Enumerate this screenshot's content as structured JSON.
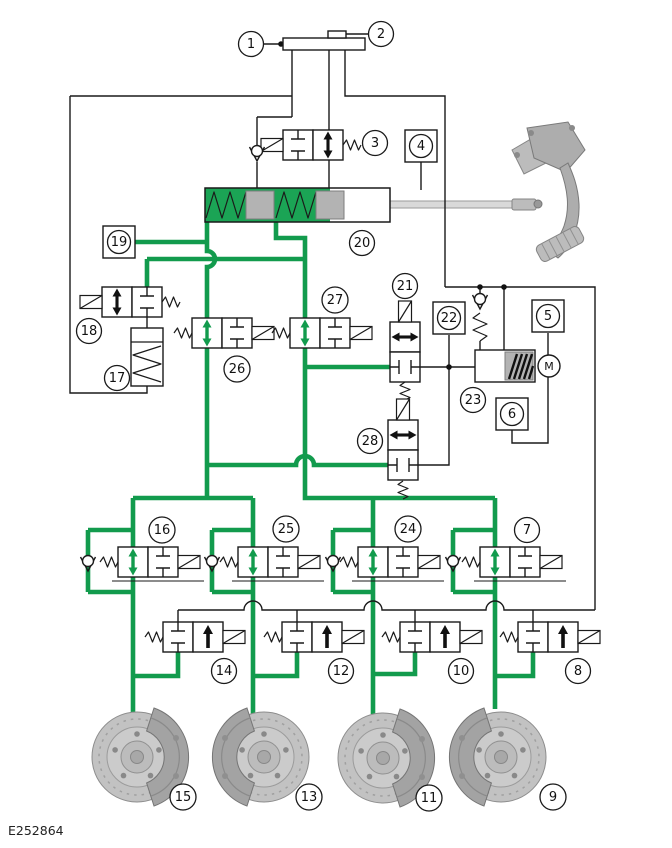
{
  "figure_code": "E252864",
  "motor_label": "M",
  "colors": {
    "hydraulic_line_green": "#129b4d",
    "schematic_line_black": "#1a1a1a",
    "component_gray": "#b3b3b3"
  },
  "callouts": {
    "1": "1",
    "2": "2",
    "3": "3",
    "4": "4",
    "5": "5",
    "6": "6",
    "7": "7",
    "8": "8",
    "9": "9",
    "10": "10",
    "11": "11",
    "12": "12",
    "13": "13",
    "14": "14",
    "15": "15",
    "16": "16",
    "17": "17",
    "18": "18",
    "19": "19",
    "20": "20",
    "21": "21",
    "22": "22",
    "23": "23",
    "24": "24",
    "25": "25",
    "26": "26",
    "27": "27",
    "28": "28"
  }
}
